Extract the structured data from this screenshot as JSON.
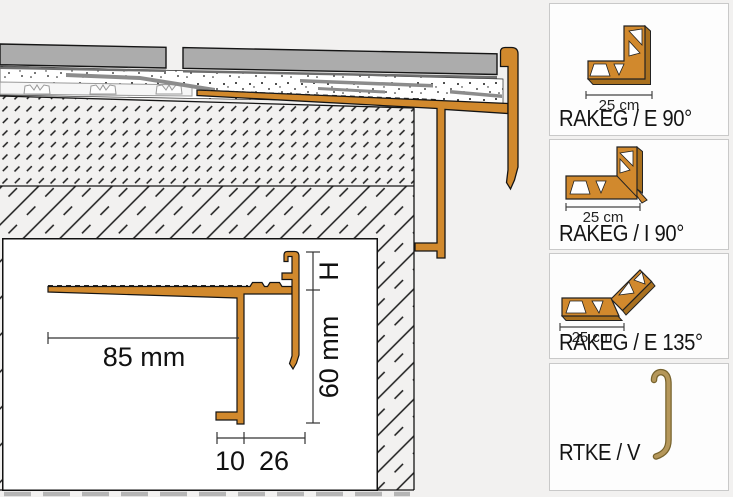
{
  "inset_detail": {
    "width_label": "85 mm",
    "height_label": "60 mm",
    "h_label": "H",
    "foot_label": "10",
    "offset_label": "26"
  },
  "sidebar": {
    "products": [
      {
        "name": "RAKEG / E 90°",
        "size": "25 cm",
        "icon": "corner-external-90-icon"
      },
      {
        "name": "RAKEG / I 90°",
        "size": "25 cm",
        "icon": "corner-internal-90-icon"
      },
      {
        "name": "RAKEG / E 135°",
        "size": "25 cm",
        "icon": "corner-external-135-icon"
      },
      {
        "name": "RTKE / V",
        "icon": "vertical-connector-icon"
      }
    ]
  },
  "colors": {
    "profile_orange": "#d1892d",
    "profile_shadow": "#a9701e",
    "connector_tan": "#b5975a",
    "tile_gray": "#acacac",
    "background": "#f2f1f0",
    "panel_border": "#c9c9c9"
  }
}
